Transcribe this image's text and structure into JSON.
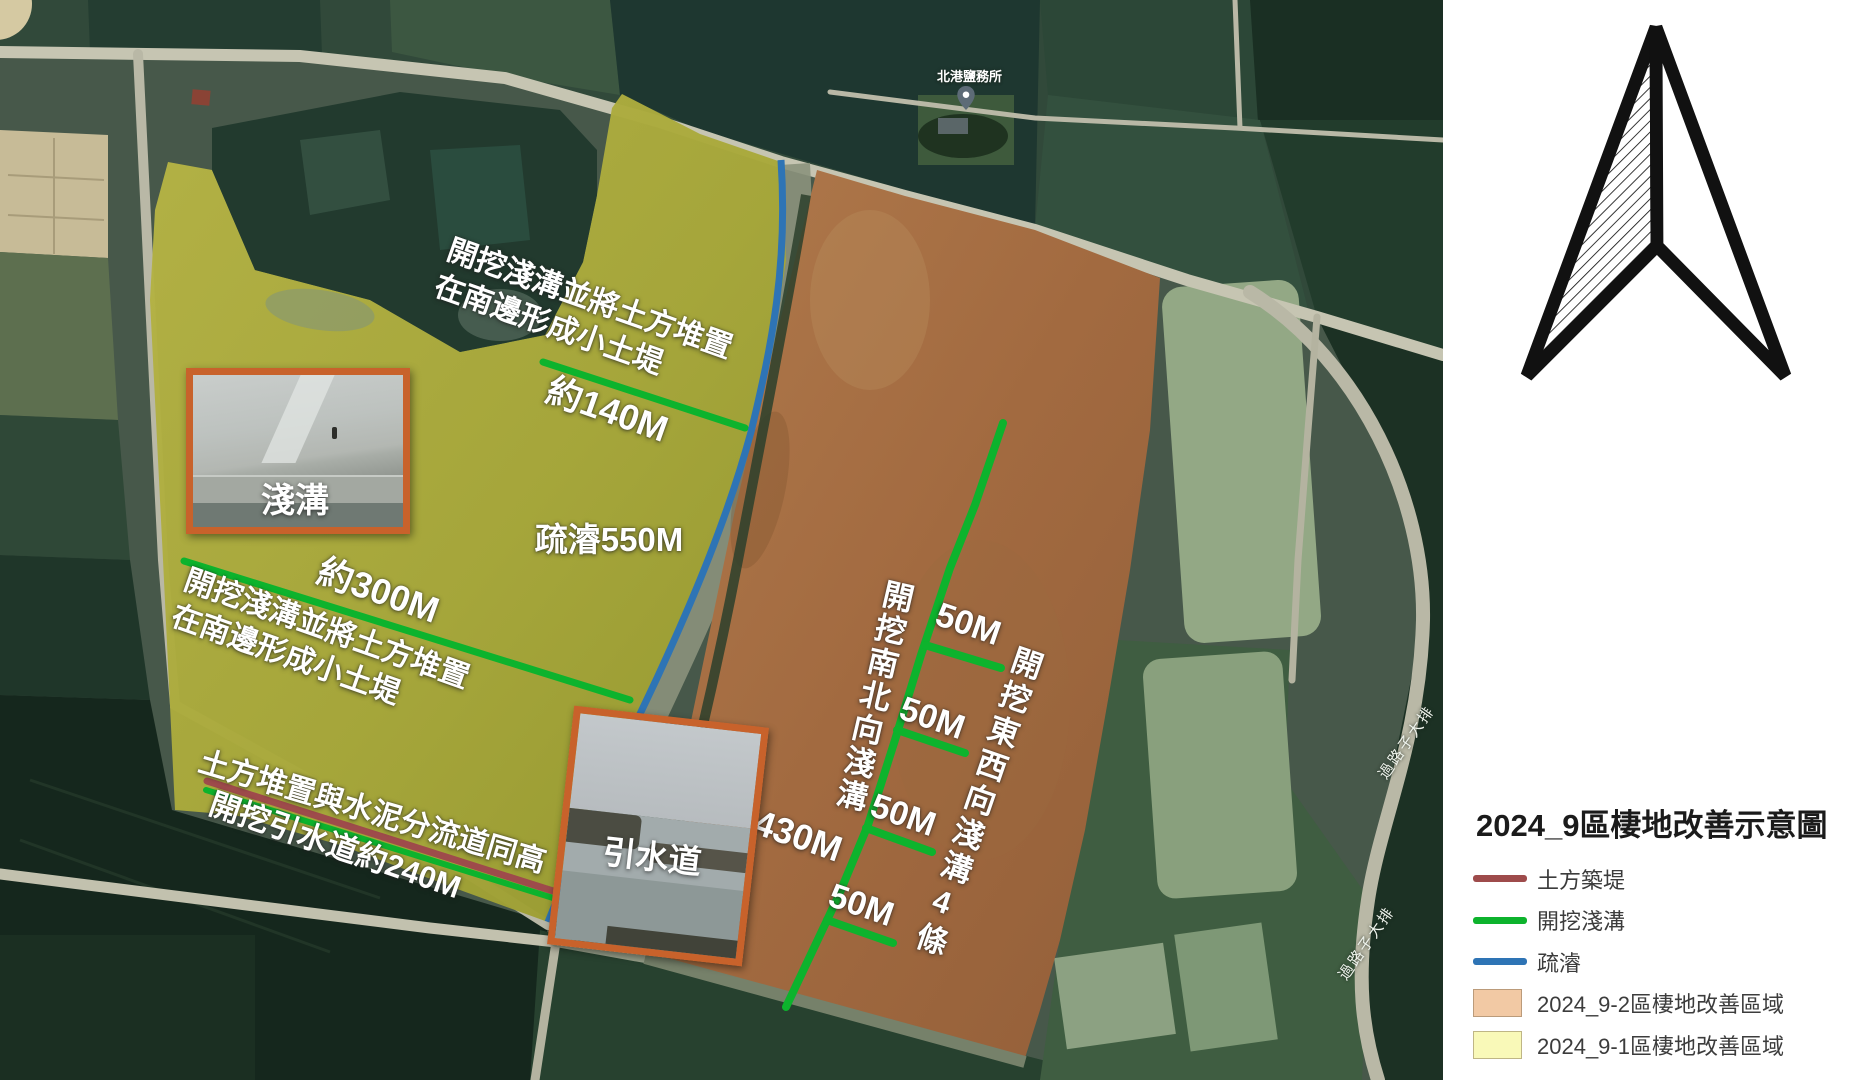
{
  "map": {
    "poi": {
      "label": "北港鹽務所"
    },
    "road_labels": {
      "upper": "過路子大排",
      "lower": "過路子大排"
    },
    "annotations": {
      "note_ne_l1": "開挖淺溝並將土方堆置",
      "note_ne_l2": "在南邊形成小土堤",
      "len_140": "約140M",
      "dredge_550": "疏濬550M",
      "len_300": "約300M",
      "note_w_l1": "開挖淺溝並將土方堆置",
      "note_w_l2": "在南邊形成小土堤",
      "note_sw_1": "土方堆置與水泥分流道同高",
      "note_sw_2": "開挖引水道約240M",
      "len_430": "430M",
      "len_50_a": "50M",
      "len_50_b": "50M",
      "len_50_c": "50M",
      "len_50_d": "50M",
      "vtext_ns": "開挖南北向淺溝",
      "vtext_ew": "開挖東西向淺溝4條"
    },
    "photos": {
      "shallow_ditch": "淺溝",
      "diversion_channel": "引水道"
    }
  },
  "panel": {
    "title": "2024_9區棲地改善示意圖",
    "legend": [
      {
        "type": "line",
        "color": "#9e4b4b",
        "label": "土方築堤"
      },
      {
        "type": "line",
        "color": "#0db32d",
        "label": "開挖淺溝"
      },
      {
        "type": "line",
        "color": "#2e74b5",
        "label": "疏濬"
      },
      {
        "type": "swatch",
        "color": "#f2c9a4",
        "label": "2024_9-2區棲地改善區域"
      },
      {
        "type": "swatch",
        "color": "#f9f9b8",
        "label": "2024_9-1區棲地改善區域"
      }
    ]
  },
  "colors": {
    "excavate_green": "#0db32d",
    "dredge_blue": "#2e74b5",
    "berm_red": "#9e4b4b",
    "photo_frame": "#c8622b"
  }
}
